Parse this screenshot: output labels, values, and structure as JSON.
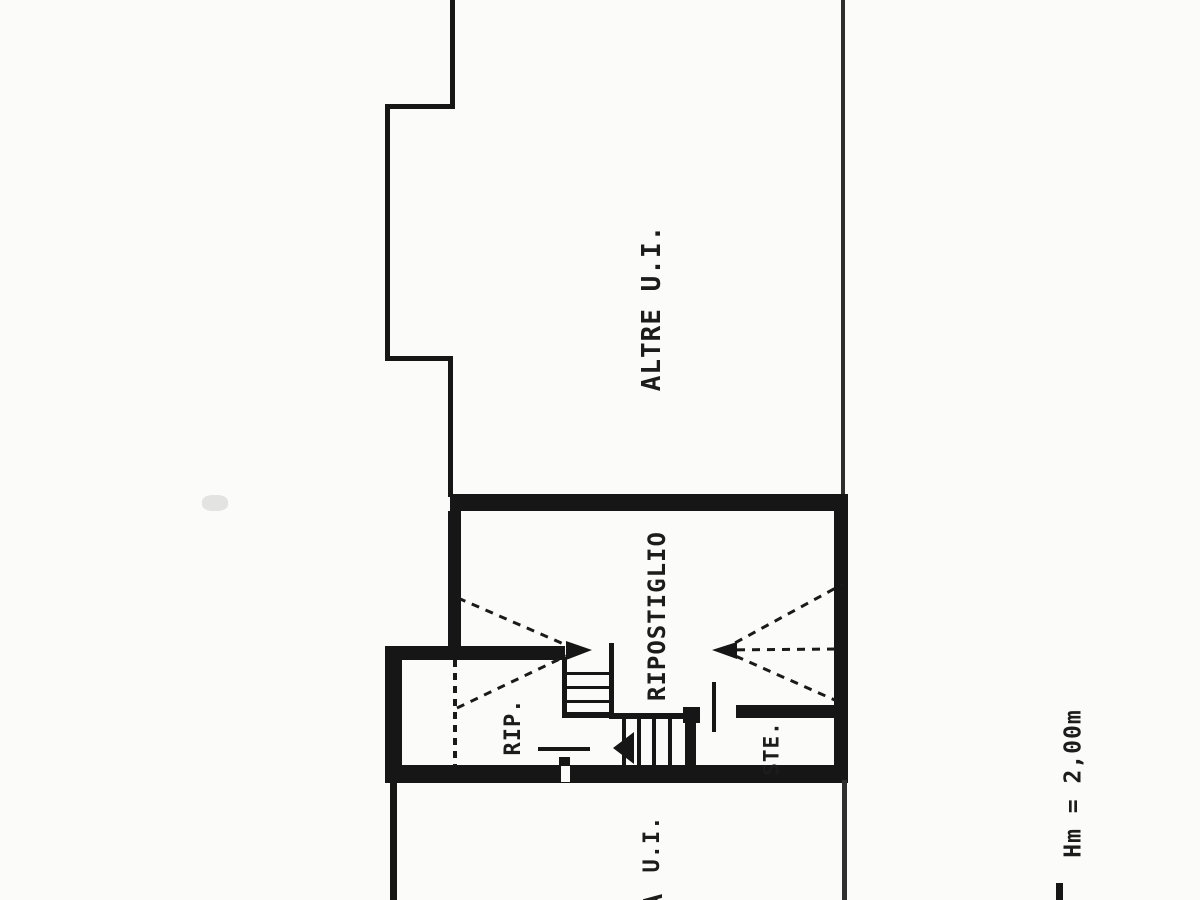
{
  "document": {
    "type": "scanned cadastral floor plan"
  },
  "labels": {
    "upper_room": "ALTRE  U.I.",
    "storage_room": "RIPOSTIGLIO",
    "small_storage_room": "RIP.",
    "ste_room": "STE.",
    "lower_room": "U.I.",
    "height_note": "Hm = 2,00m",
    "cut_off_letter": "A"
  },
  "colors": {
    "line": "#161616",
    "background": "#fbfbfa"
  }
}
